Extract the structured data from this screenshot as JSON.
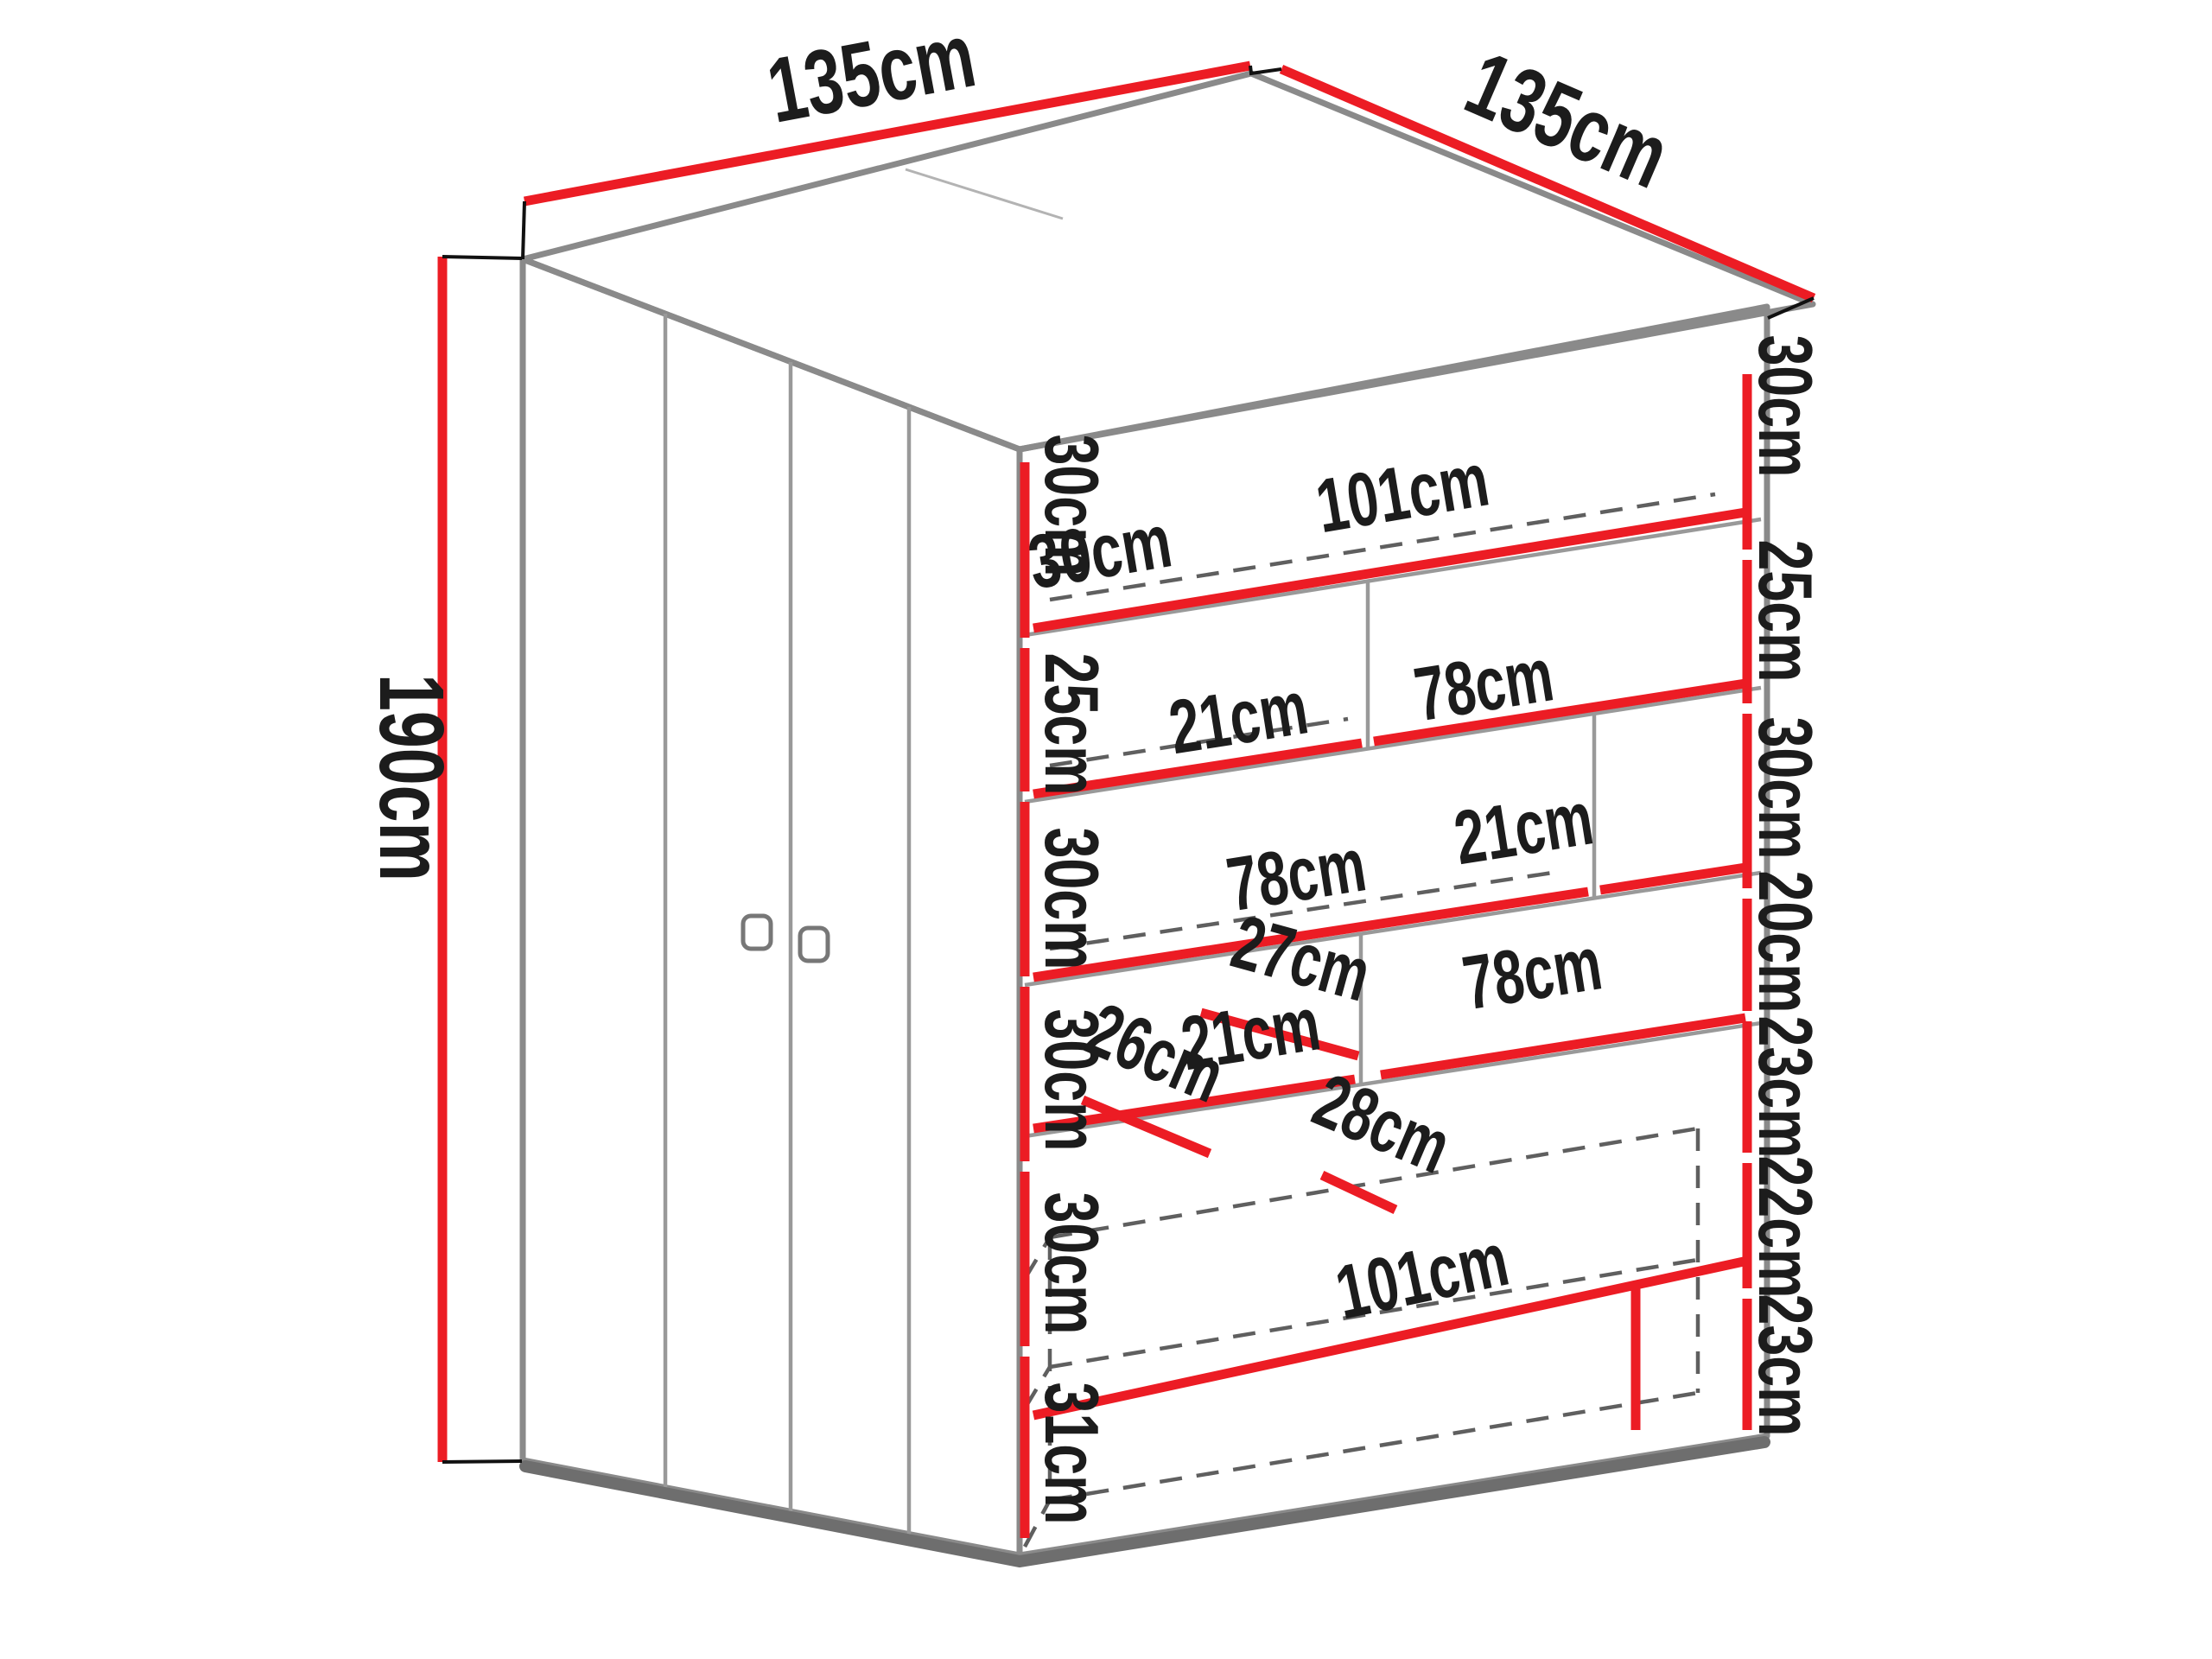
{
  "diagram": {
    "type": "furniture-dimension-diagram",
    "subject": "corner wardrobe with open shelf section and hidden drawers",
    "units": "cm",
    "colors": {
      "dimension_line": "#ec1c24",
      "structure_line": "#8a8a8a",
      "text": "#1c1c1c",
      "background": "#ffffff"
    },
    "overall": {
      "width_left": "135cm",
      "width_right": "135cm",
      "height": "190cm"
    },
    "left_heights": {
      "h1": "30cm",
      "h2": "25cm",
      "h3": "30cm",
      "h4": "30cm",
      "h5": "30cm",
      "h6": "31cm"
    },
    "right_heights": {
      "h1": "30cm",
      "h2": "25cm",
      "h3": "30cm",
      "h4": "20cm",
      "h5": "23cm",
      "h6": "22cm",
      "h7": "23cm"
    },
    "interior": {
      "shelf1_depth": "30cm",
      "shelf1_width": "101cm",
      "shelf2_left_width": "21cm",
      "shelf2_right_width": "78cm",
      "shelf3_left_width": "78cm",
      "shelf3_right_width": "21cm",
      "shelf4_left_width": "21cm",
      "shelf4_left_depth": "27cm",
      "shelf4_right_width": "78cm",
      "niche_depth": "26cm",
      "drawer_depth": "28cm",
      "bottom_width": "101cm"
    }
  }
}
